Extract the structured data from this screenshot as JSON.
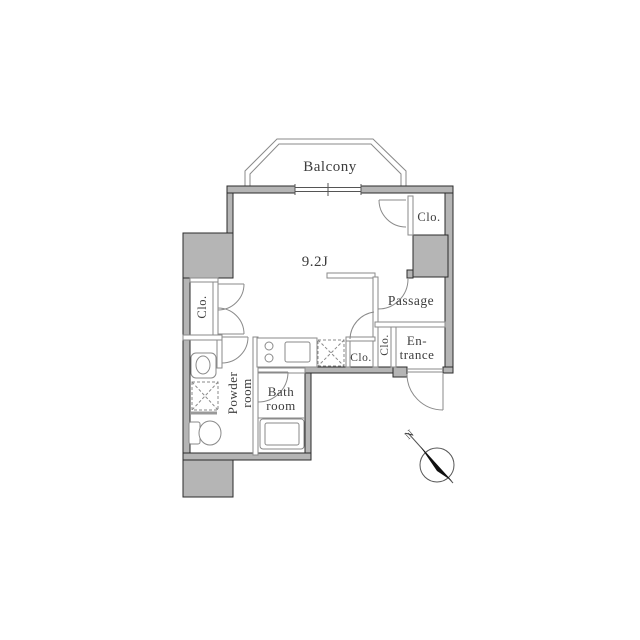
{
  "labels": {
    "balcony": "Balcony",
    "main_room_size": "9.2J",
    "closet_top_right": "Clo.",
    "closet_left": "Clo.",
    "closet_hall_small": "Clo.",
    "closet_hall_narrow": "Clo.",
    "passage": "Passage",
    "entrance_line1": "En-",
    "entrance_line2": "trance",
    "bath_line1": "Bath",
    "bath_line2": "room",
    "powder_line1": "Powder",
    "powder_line2": "room",
    "compass_north": "N"
  },
  "colors": {
    "wall_fill": "#b5b5b5",
    "wall_outline": "#2b2b2b",
    "thin_line": "#8a8a8a",
    "text": "#3d3d3d",
    "needle": "#101010",
    "background": "#ffffff"
  }
}
